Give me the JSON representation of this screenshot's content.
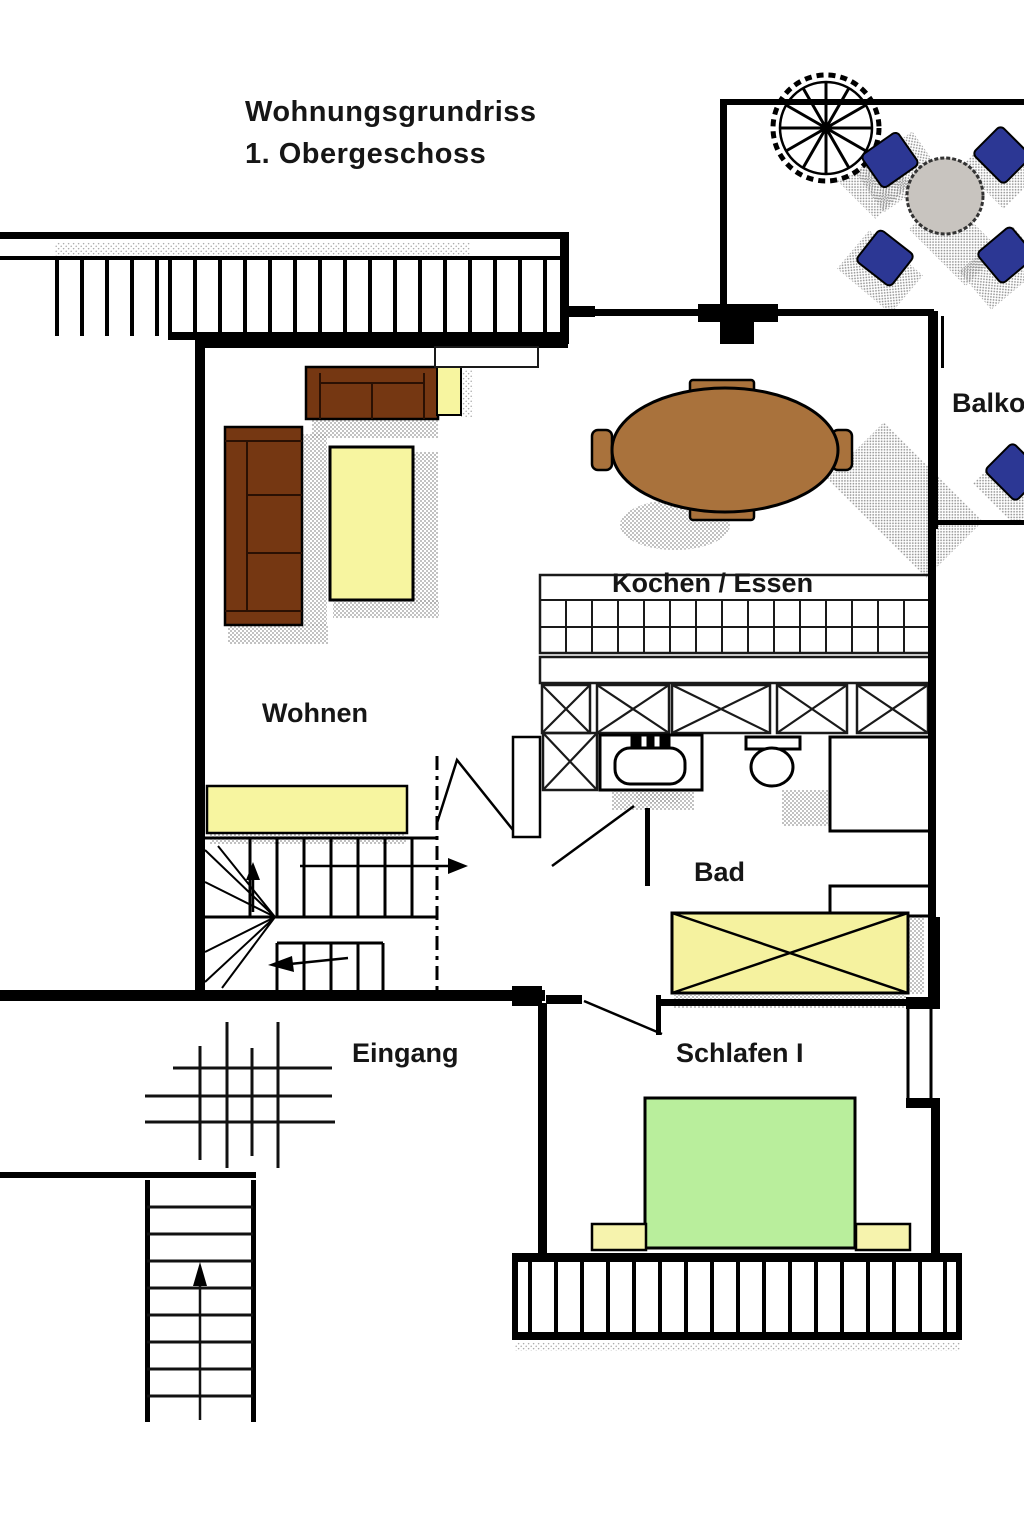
{
  "title": {
    "line1": "Wohnungsgrundriss",
    "line2": "1. Obergeschoss"
  },
  "rooms": {
    "living": "Wohnen",
    "kitchen": "Kochen / Essen",
    "bath": "Bad",
    "bedroom": "Schlafen I",
    "entrance": "Eingang",
    "balcony": "Balkon"
  },
  "colors": {
    "wall": "#000000",
    "label": "#161616",
    "sofa": "#753712",
    "coffee_table": "#f7f5a0",
    "side_table": "#f7f5a0",
    "sideboard": "#f7f5a0",
    "dining_table": "#a9723c",
    "bed": "#b9ee9c",
    "nightstand": "#f6f3ad",
    "wardrobe": "#f5f29f",
    "terrace_table": "#c8c4bf",
    "terrace_chair": "#2c3794",
    "shadow": "#8f8f8f"
  }
}
